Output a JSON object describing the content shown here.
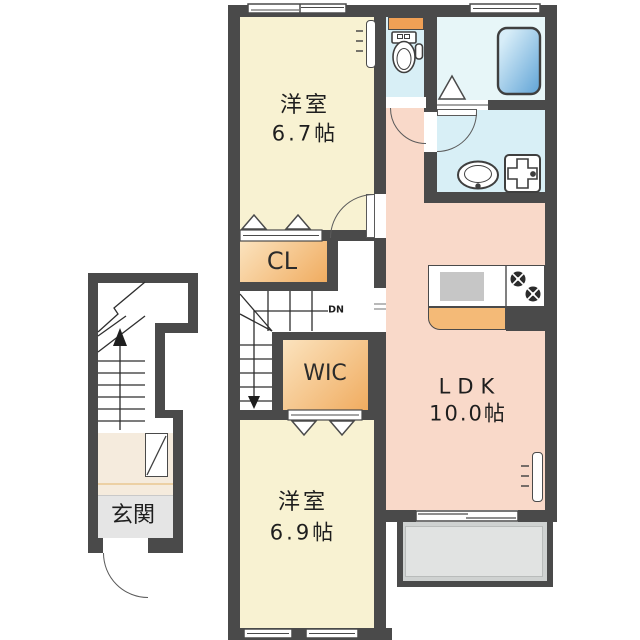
{
  "rooms": {
    "bedroom_top": {
      "label": "洋室",
      "size": "6.7帖"
    },
    "bedroom_bottom": {
      "label": "洋室",
      "size": "6.9帖"
    },
    "ldk": {
      "label": "LDK",
      "size": "10.0帖"
    },
    "closet": {
      "label": "CL"
    },
    "wic": {
      "label": "WIC"
    },
    "entrance": {
      "label": "玄関"
    }
  },
  "stairs": {
    "down_label": "DN"
  },
  "fixtures": [
    "toilet",
    "toilet-shelf",
    "bathtub",
    "bath-folding-door",
    "washbasin",
    "washing-machine-pan",
    "kitchen-sink",
    "gas-stove-burners",
    "shoe-cabinet",
    "air-conditioner",
    "balcony",
    "sliding-windows",
    "door-swing-arcs"
  ],
  "colors": {
    "wall": "#4a4a4a",
    "bedroom_floor": "#f8f2d2",
    "ldk_floor": "#f9d9c9",
    "wet_area_floor": "#d8eff6",
    "bath_floor": "#e7f6f8",
    "storage_gradient_light": "#fbe3be",
    "storage_gradient_dark": "#f0ac60",
    "balcony": "#cfd2d1",
    "balcony_inner": "#e1e3e2",
    "entrance_floor": "#f5ebdd",
    "entrance_strip": "#e5e5e5",
    "bathtub": "#5fa3d6",
    "accent_orange": "#f0a055"
  }
}
